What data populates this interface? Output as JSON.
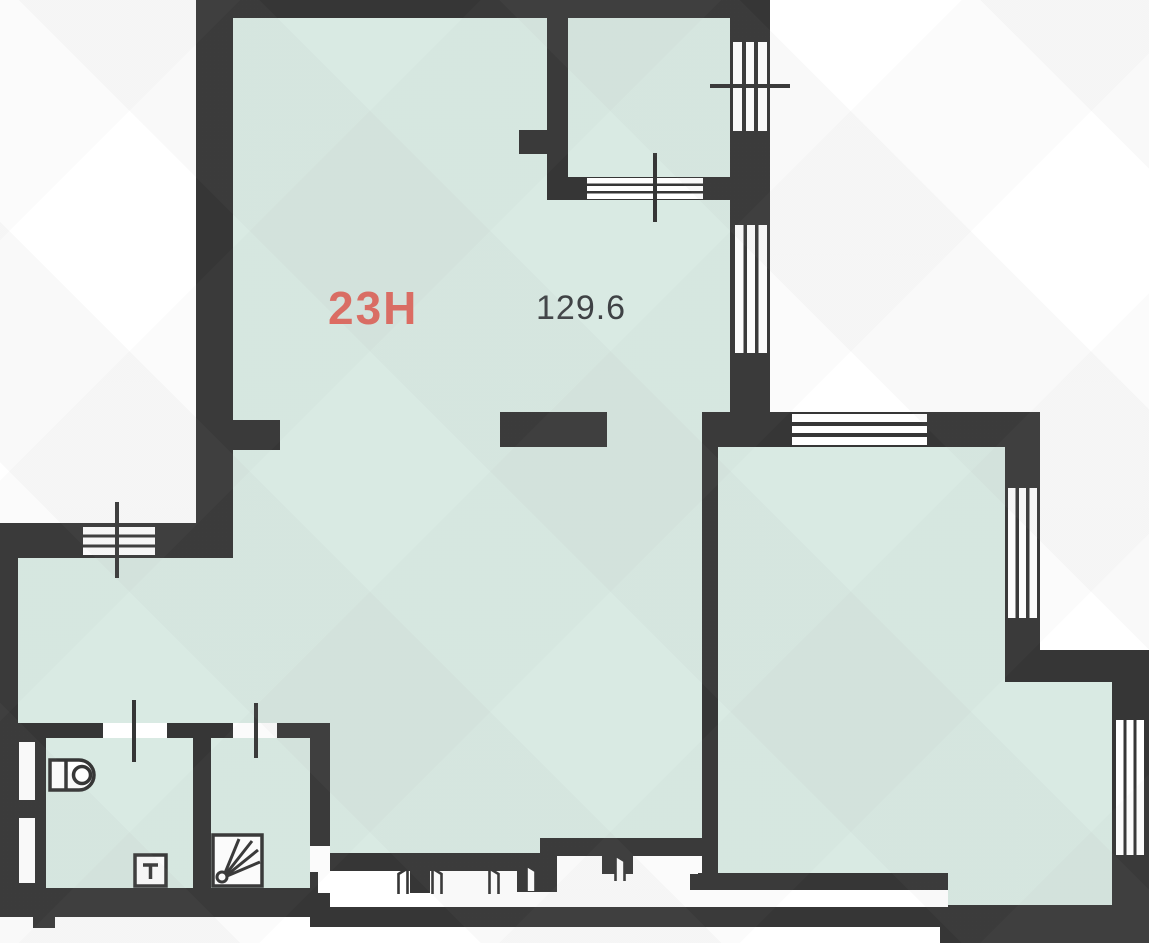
{
  "unit": {
    "number_label": "23H",
    "area_label": "129.6"
  },
  "colors": {
    "wall": "#363636",
    "floor": "#d9eae3",
    "accent": "#e0695f",
    "text": "#3f4245",
    "bg": "#ffffff"
  },
  "fixtures": [
    "toilet",
    "sink",
    "shower"
  ],
  "symbols": {
    "window": "triple-stripe-opening",
    "door": "white-gap-with-leaf",
    "axis_tick": "cross-line"
  }
}
